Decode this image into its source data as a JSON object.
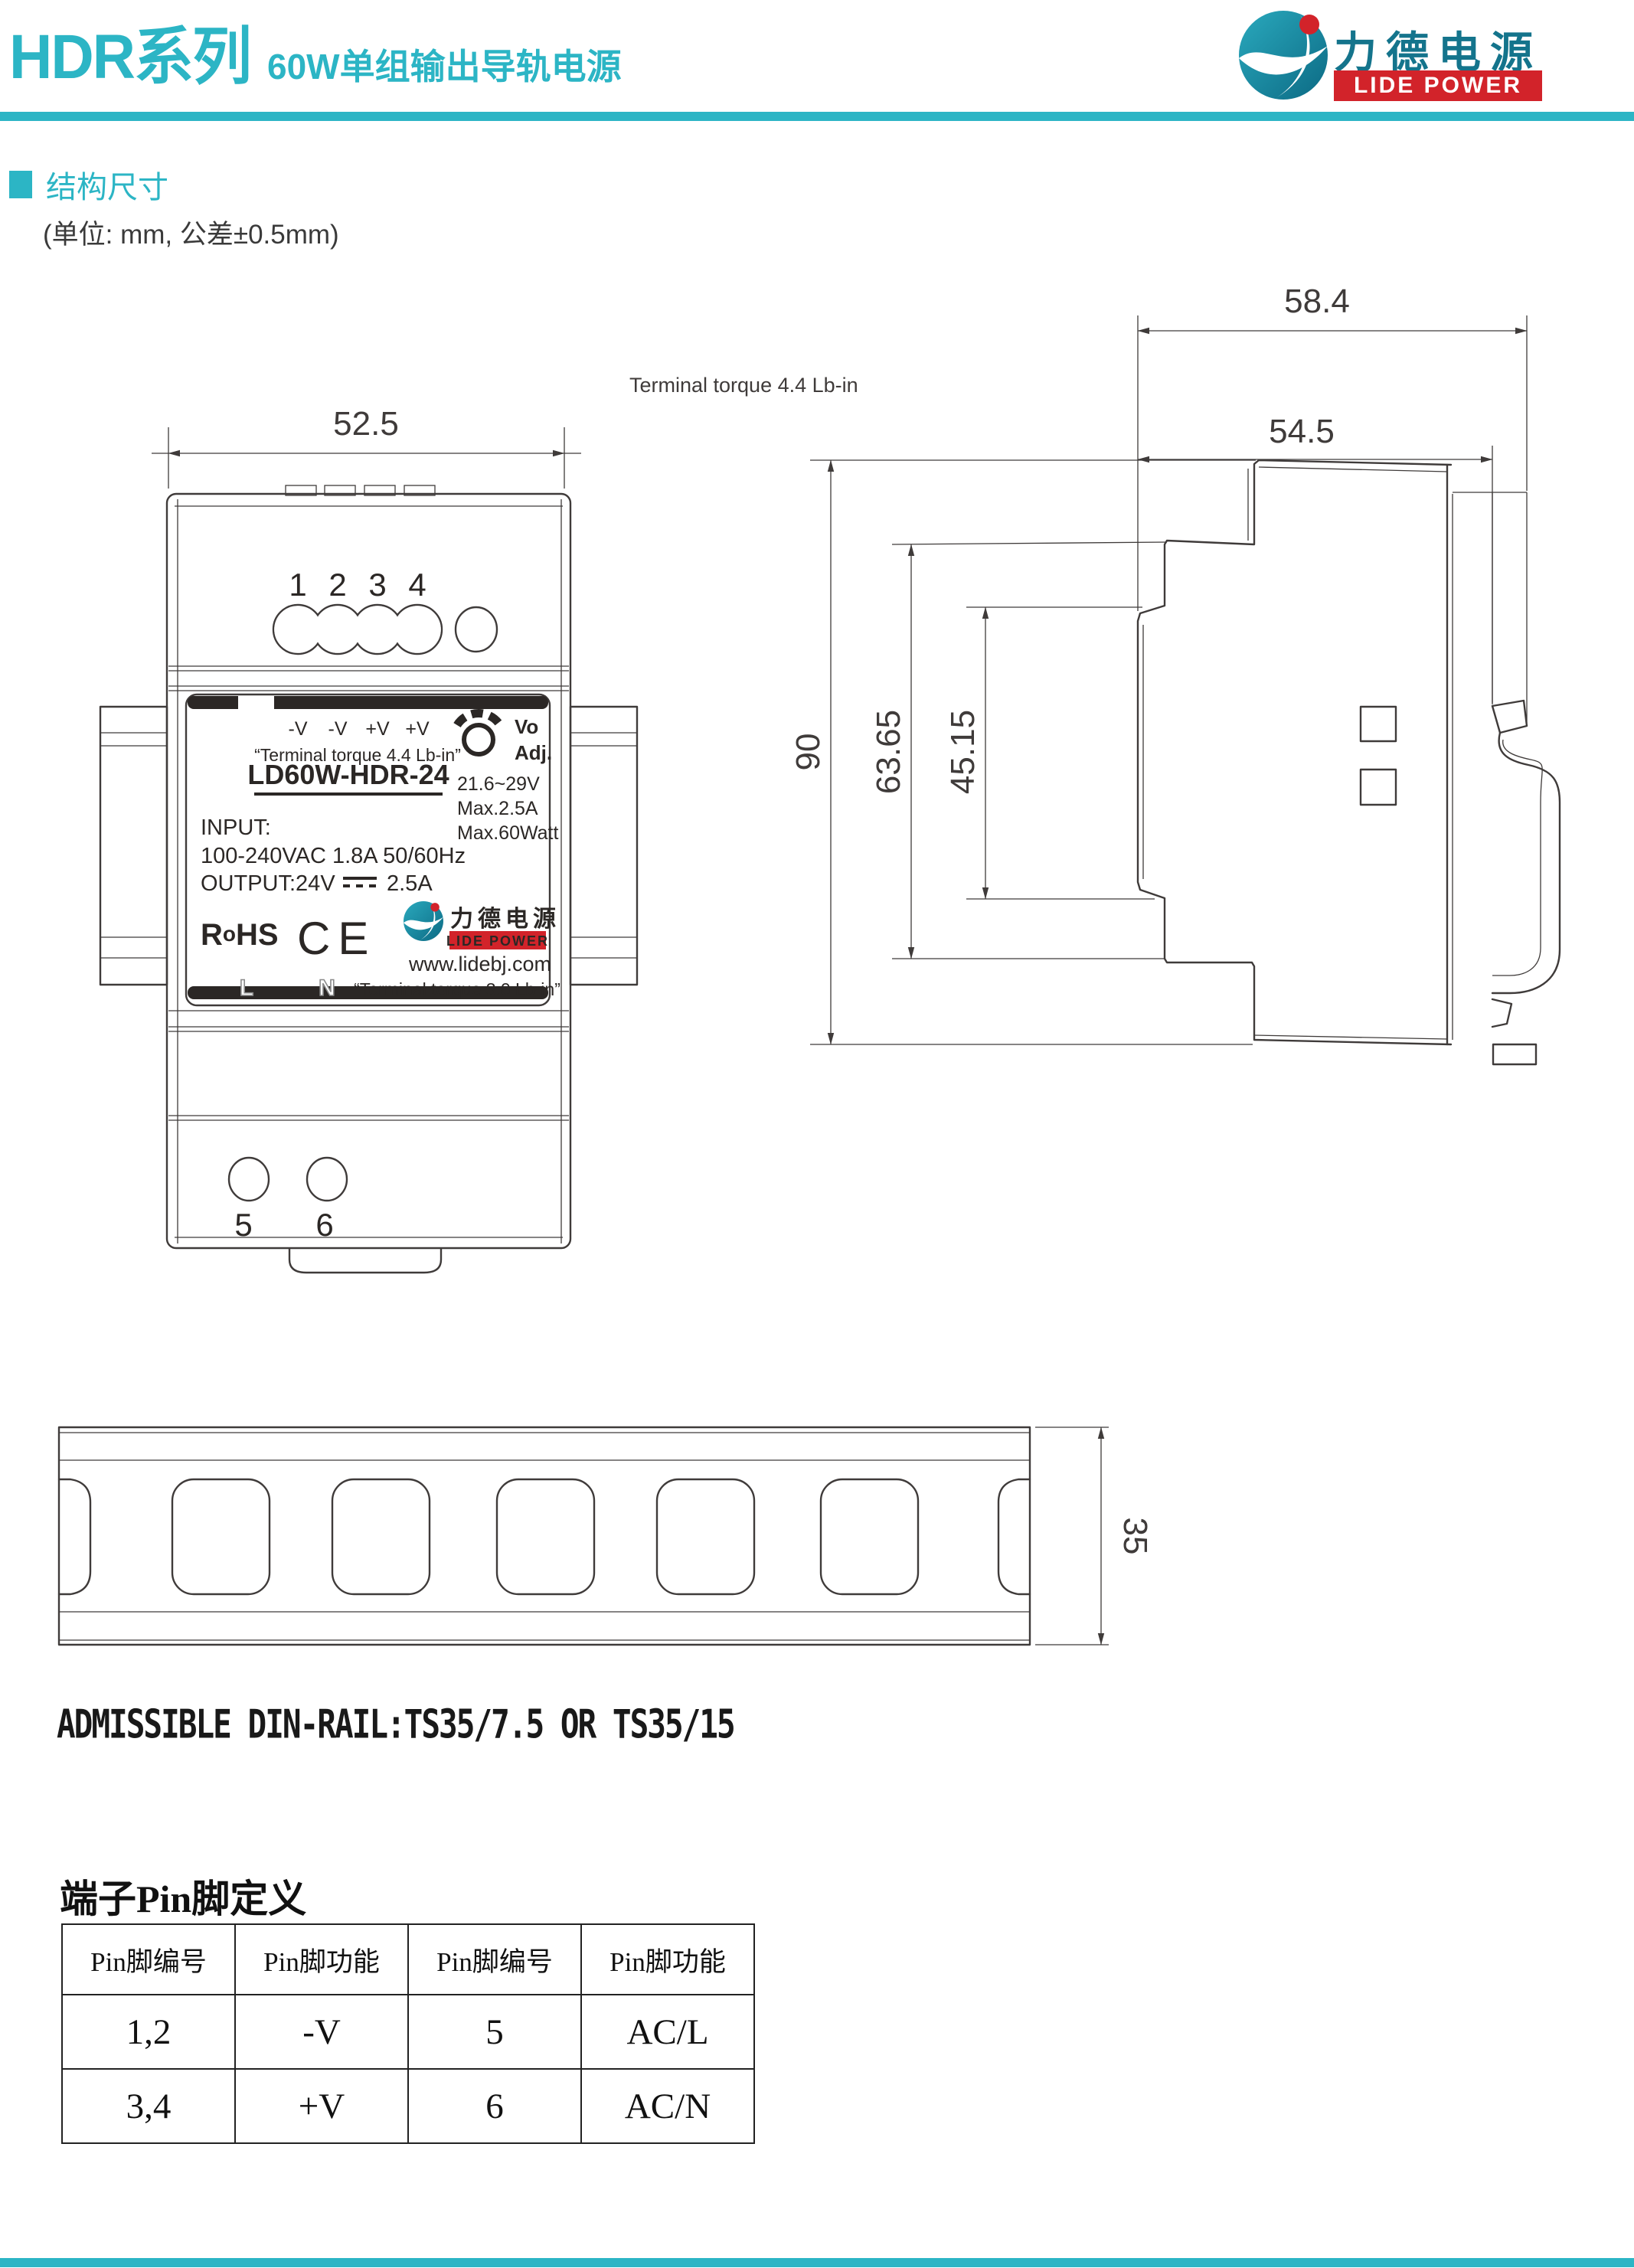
{
  "header": {
    "series": "HDR系列",
    "subtitle": "60W单组输出导轨电源",
    "logo_cn": "力德电源",
    "logo_en": "LIDE POWER"
  },
  "section": {
    "title": "结构尺寸",
    "unit_note": "(单位: mm, 公差±0.5mm)"
  },
  "annotations": {
    "terminal_torque": "Terminal torque 4.4 Lb-in"
  },
  "dims": {
    "front_width": "52.5",
    "side_total_depth": "58.4",
    "side_body_depth": "54.5",
    "side_height": "90",
    "side_mid_height": "63.65",
    "side_front_height": "45.15",
    "rail_height": "35"
  },
  "front_view": {
    "top_pins": [
      "1",
      "2",
      "3",
      "4"
    ],
    "bottom_pins": [
      "5",
      "6"
    ]
  },
  "front_label": {
    "terminals": [
      "-V",
      "-V",
      "+V",
      "+V"
    ],
    "torque_top": "“Terminal torque 4.4 Lb-in”",
    "knob_line1": "Vo",
    "knob_line2": "Adj.",
    "model": "LD60W-HDR-24",
    "spec1": "21.6~29V",
    "spec2": "Max.2.5A",
    "spec3": "Max.60Watt",
    "input_label": "INPUT:",
    "input_value": "100-240VAC 1.8A  50/60Hz",
    "output_label": "OUTPUT:24V",
    "output_amp": "2.5A",
    "rohs_r": "R",
    "rohs_o": "o",
    "rohs_hs": "HS",
    "ce": "CE",
    "logo_cn": "力德电源",
    "logo_en": "LIDE POWER",
    "website": "www.lidebj.com",
    "line": "L",
    "neutral": "N",
    "torque_bottom": "“Terminal torque 3.0 Lb-in”"
  },
  "din_rail": {
    "note": "ADMISSIBLE DIN-RAIL:TS35/7.5 OR TS35/15"
  },
  "pin_table": {
    "title": "端子Pin脚定义",
    "headers": [
      "Pin脚编号",
      "Pin脚功能",
      "Pin脚编号",
      "Pin脚功能"
    ],
    "rows": [
      [
        "1,2",
        "-V",
        "5",
        "AC/L"
      ],
      [
        "3,4",
        "+V",
        "6",
        "AC/N"
      ]
    ]
  },
  "colors": {
    "accent": "#2cb5c5",
    "logo_red": "#d2232a",
    "logo_teal_dark": "#14748c",
    "line": "#3f3b3a"
  }
}
